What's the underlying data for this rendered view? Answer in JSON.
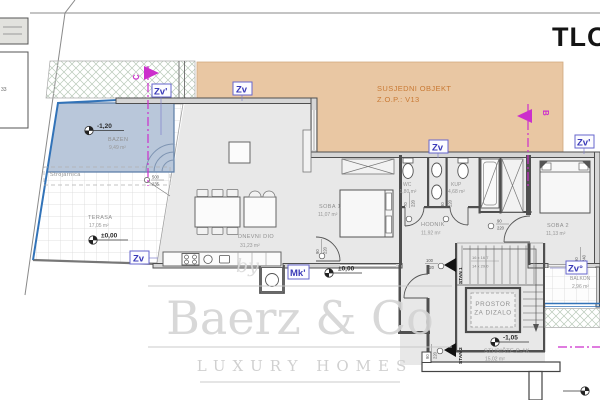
{
  "title": "TLOCRT",
  "legend": {
    "side_label": "33"
  },
  "neighbor": {
    "line1": "SUSJEDNI OBJEKT",
    "line2": "Z.O.P.: V13"
  },
  "watermark": {
    "by": "by",
    "brand": "Baerz & Co",
    "tagline": "LUXURY HOMES"
  },
  "rooms": {
    "bazen": {
      "name": "BAZEN",
      "area": "9,49 m²",
      "level": "-1,20"
    },
    "terasa": {
      "name": "TERASA",
      "area": "17,05 m²",
      "level": "±0,00"
    },
    "strojarnica": {
      "name": "Strojarnica"
    },
    "dnevni": {
      "name": "DNEVNI DIO",
      "area": "31,23 m²",
      "level": "±0,00"
    },
    "soba1": {
      "name": "SOBA 1",
      "area": "11,07 m²"
    },
    "wc": {
      "name": "WC",
      "area": "1,80 m²"
    },
    "kup": {
      "name": "KUP",
      "area": "4,68 m²"
    },
    "hodnik": {
      "name": "HODNIK",
      "area": "11,92 m²"
    },
    "soba2": {
      "name": "SOBA 2",
      "area": "11,13 m²"
    },
    "dizalo": {
      "line1": "PROSTOR",
      "line2": "ZA DIZALO"
    },
    "stubiste": {
      "name": "STUBIŠTE P-1K",
      "area": "15,02 m²",
      "level": "-1,05"
    },
    "balkon": {
      "name": "BALKON",
      "area": "2,96 m²"
    }
  },
  "apartments": {
    "stan1": "STAN 1",
    "stan2": "STAN 2"
  },
  "sections": {
    "b": "B",
    "c": "C"
  },
  "markers": {
    "zv": "Zv",
    "zv_prime": "Zv'",
    "zv_deg": "Zv°",
    "mk": "Mk'"
  },
  "dims": {
    "terasa": {
      "w": "500",
      "h": "235"
    },
    "soba1_door": {
      "w": "90",
      "h": "220"
    },
    "wc_door": {
      "w": "70",
      "h": "220"
    },
    "kup_door": {
      "w": "80",
      "h": "220"
    },
    "soba2_door": {
      "w": "90",
      "h": "220"
    },
    "stan1_door": {
      "w": "100",
      "h": "220"
    },
    "stan2_door": {
      "w": "90",
      "h": "220"
    },
    "balkon_door": {
      "w": "90",
      "h": "240"
    },
    "stairs_line1": "16 x 16,7",
    "stairs_line2": "14 x 29,0"
  },
  "colors": {
    "accent_magenta": "#cc2fcc",
    "marker_blue": "#3a3ab8",
    "neighbor_fill": "#e9c7a3",
    "neighbor_text": "#c97a35",
    "pool_fill": "#b9c7da",
    "pool_edge": "#3273b8",
    "floor_fill": "#e8e8e8",
    "wall": "#4f4f4f",
    "watermark": "#d4d4d4"
  }
}
